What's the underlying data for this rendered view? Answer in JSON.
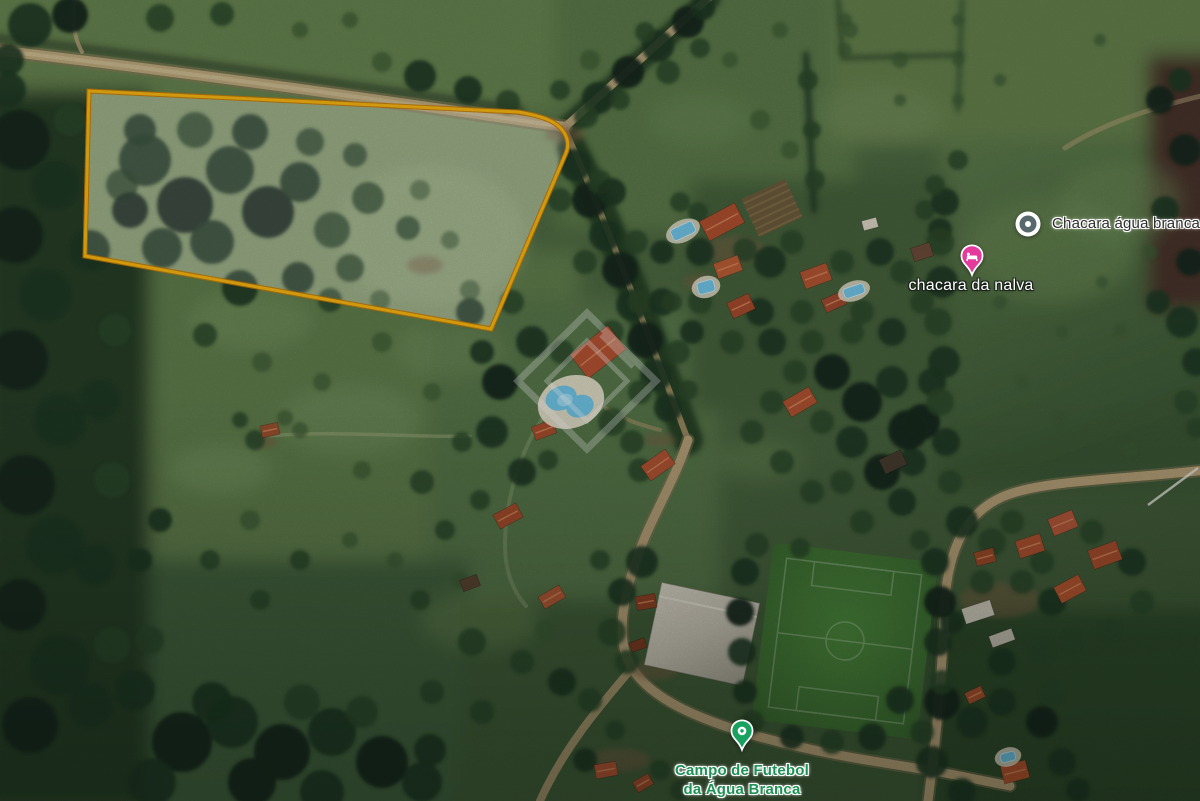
{
  "map": {
    "view_type": "satellite",
    "parcel_outline": {
      "stroke_color": "#f7b513",
      "fill_color": "rgba(255,255,255,0.17)"
    },
    "watermark": {
      "shape": "double-diamond-logo",
      "color": "#ffffff"
    },
    "markers": [
      {
        "id": "chacara-agua-branca",
        "label": "Chacara água branca",
        "icon": "poi-dot-icon",
        "pin_color": "#57696c",
        "label_color": "#2e2e2e"
      },
      {
        "id": "chacara-da-nalva",
        "label": "chacara da nalva",
        "icon": "lodging-pin-icon",
        "pin_color": "#e43a9c",
        "label_color": "#ffffff"
      },
      {
        "id": "campo-de-futebol-da-agua-branca",
        "label_lines": [
          "Campo de Futebol",
          "da Água Branca"
        ],
        "icon": "park-pin-icon",
        "pin_color": "#18a15f",
        "label_color": "#1f9156"
      }
    ]
  }
}
